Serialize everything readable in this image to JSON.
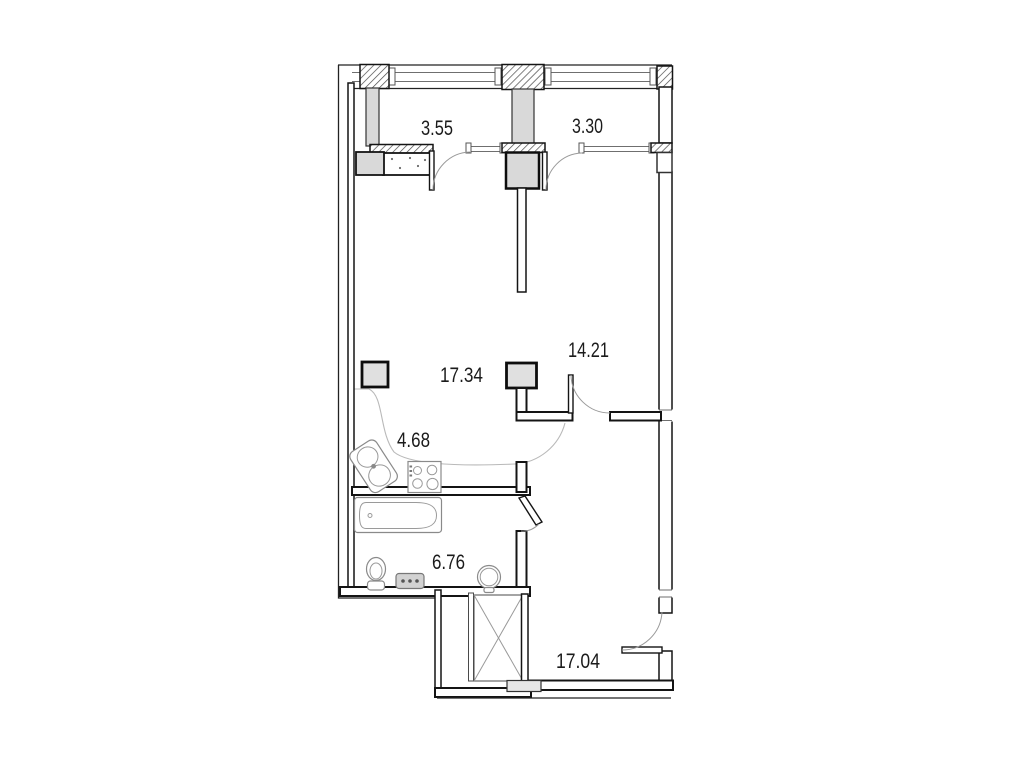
{
  "plan": {
    "type": "apartment-floor-plan",
    "rooms": [
      {
        "name": "balcony-left",
        "area": "3.55"
      },
      {
        "name": "balcony-right",
        "area": "3.30"
      },
      {
        "name": "living-room",
        "area": "17.34"
      },
      {
        "name": "bedroom",
        "area": "14.21"
      },
      {
        "name": "kitchen-niche",
        "area": "4.68"
      },
      {
        "name": "bathroom",
        "area": "6.76"
      },
      {
        "name": "entrance-room",
        "area": "17.04"
      }
    ],
    "fixtures": [
      "kitchen-sink",
      "stove",
      "bathtub",
      "toilet",
      "washing-machine",
      "wash-basin",
      "ventilation-shaft"
    ],
    "colors": {
      "wall": "#141414",
      "label": "#1b1b1b",
      "column_fill": "#e0e0e0",
      "pier_gray": "#d9d9d9",
      "threshold_fill": "#e6e6e6",
      "washer_fill": "#d2d2d2",
      "fixture_line": "#8a8a8a"
    }
  }
}
